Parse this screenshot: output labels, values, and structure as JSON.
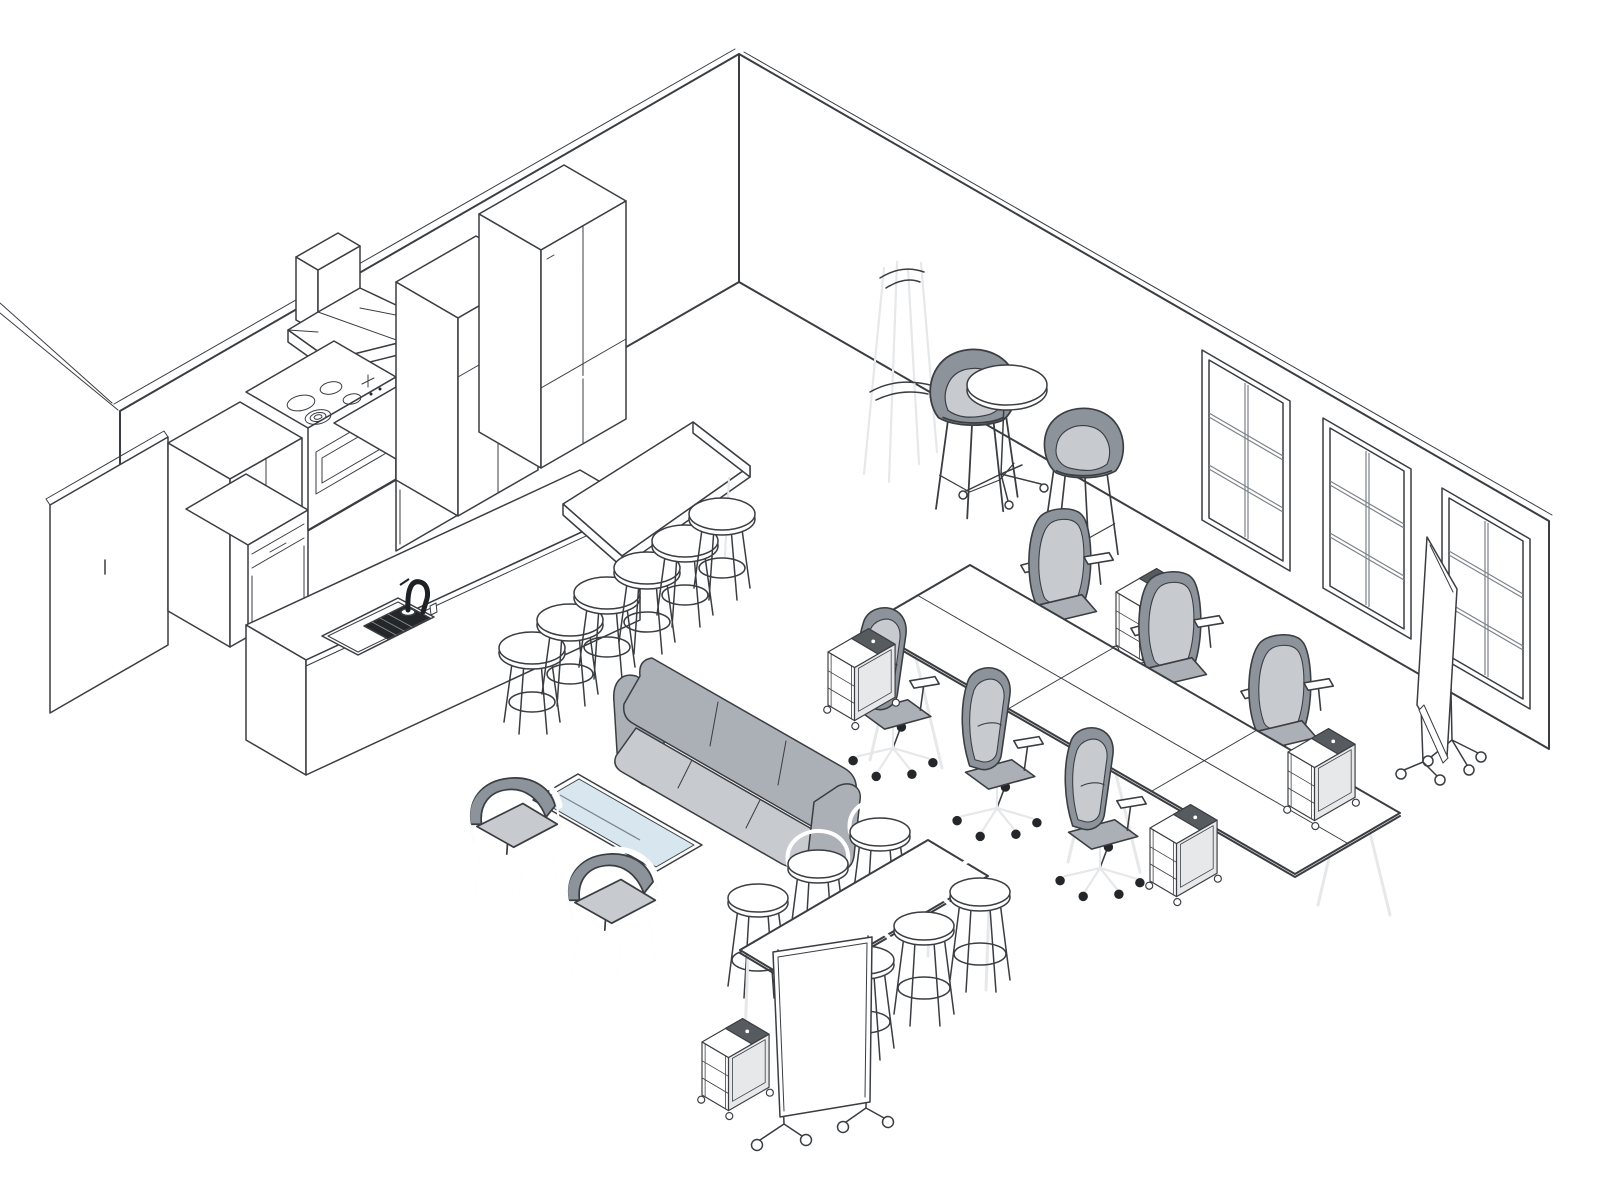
{
  "scene": {
    "kind": "isometric-interior-line-drawing",
    "room": {
      "walls": [
        "left-wall",
        "right-wall"
      ],
      "windows_on_right_wall": 3,
      "window_panes_per_window": 6,
      "freestanding_wall_panel": 1
    },
    "kitchen": {
      "appliances": [
        "tall-wardrobe-cabinet",
        "pantry-cabinet",
        "base-cabinets",
        "range-hood",
        "range-with-cooktop",
        "tall-storage-cabinet",
        "french-door-refrigerator"
      ],
      "island": {
        "segments": [
          "sink-counter",
          "raised-bar-counter"
        ],
        "sink": true,
        "gooseneck-faucet": true,
        "stools": 6
      }
    },
    "cafe_corner": {
      "coat-stand": 1,
      "bistro-table": 1,
      "upholstered-bar-chairs": 2
    },
    "conference_area": {
      "table_panels": 6,
      "task_chairs_far_side": 3,
      "task_chairs_near_side": 3,
      "storage_carts": 4
    },
    "lounge": {
      "sofa_seats": 3,
      "glass-coffee-table": 1,
      "wood-lounge-chairs": 2
    },
    "standing_table_area": {
      "bar_height_table": 1,
      "bar_stools_with_backs": 6,
      "storage_carts": 1
    },
    "mobile_whiteboards": 2
  },
  "inventory_counts": {
    "stools_total": 12,
    "chairs_total": 10,
    "carts_total": 5,
    "whiteboards_total": 2,
    "windows_total": 3
  },
  "colors": {
    "line": "#3a3d41",
    "ink": "#24272a",
    "wall": "#ffffff",
    "gray_dark": "#8d939a",
    "gray_mid": "#aab0b6",
    "gray_light": "#c7cbcf",
    "gray_pale": "#e6e8ea",
    "glass": "#d8e6ef",
    "slot": "#565b60",
    "mullion": "#7d838a"
  }
}
